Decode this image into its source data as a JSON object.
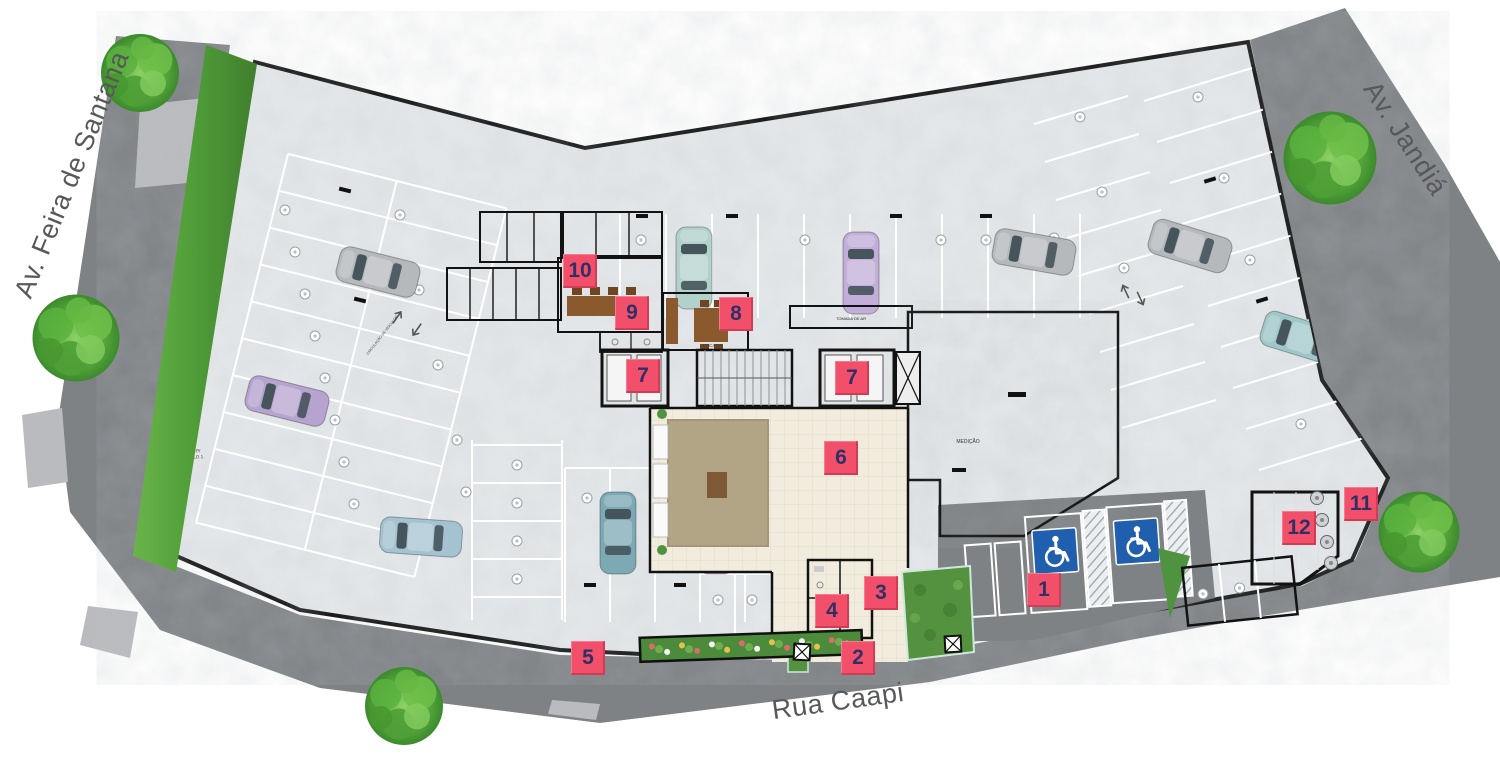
{
  "streets": {
    "left": "Av. Feira de Santana",
    "right": "Av. Jandiá",
    "bottom": "Rua Caapi"
  },
  "markers": [
    "1",
    "2",
    "3",
    "4",
    "5",
    "6",
    "7",
    "7",
    "8",
    "9",
    "10",
    "11",
    "12"
  ],
  "plan_labels": {
    "stairs": "ESCADA",
    "metering": "MEDIÇÃO",
    "air_intake": "TOMADA DE AR",
    "ramp_line1": "DESCE P/",
    "ramp_line2": "SUBSOLO 1",
    "vehicle_circulation": "CIRCULAÇÃO DE VEÍCULOS",
    "gas": "CENTRAL DE GÁS"
  },
  "colors": {
    "marker_bg": "#f2506a",
    "marker_number": "#2e3066",
    "road": "#7f8285",
    "road_light": "#b9bbbe",
    "hedge_green": "#58a33f",
    "tree_green": "#55a83a",
    "slab": "#e6e9eb",
    "dark_patio": "#9a9da1",
    "lobby_floor": "#f1ecdd",
    "sign_blue": "#1f5fae",
    "planter_green": "#4c8a3c"
  }
}
